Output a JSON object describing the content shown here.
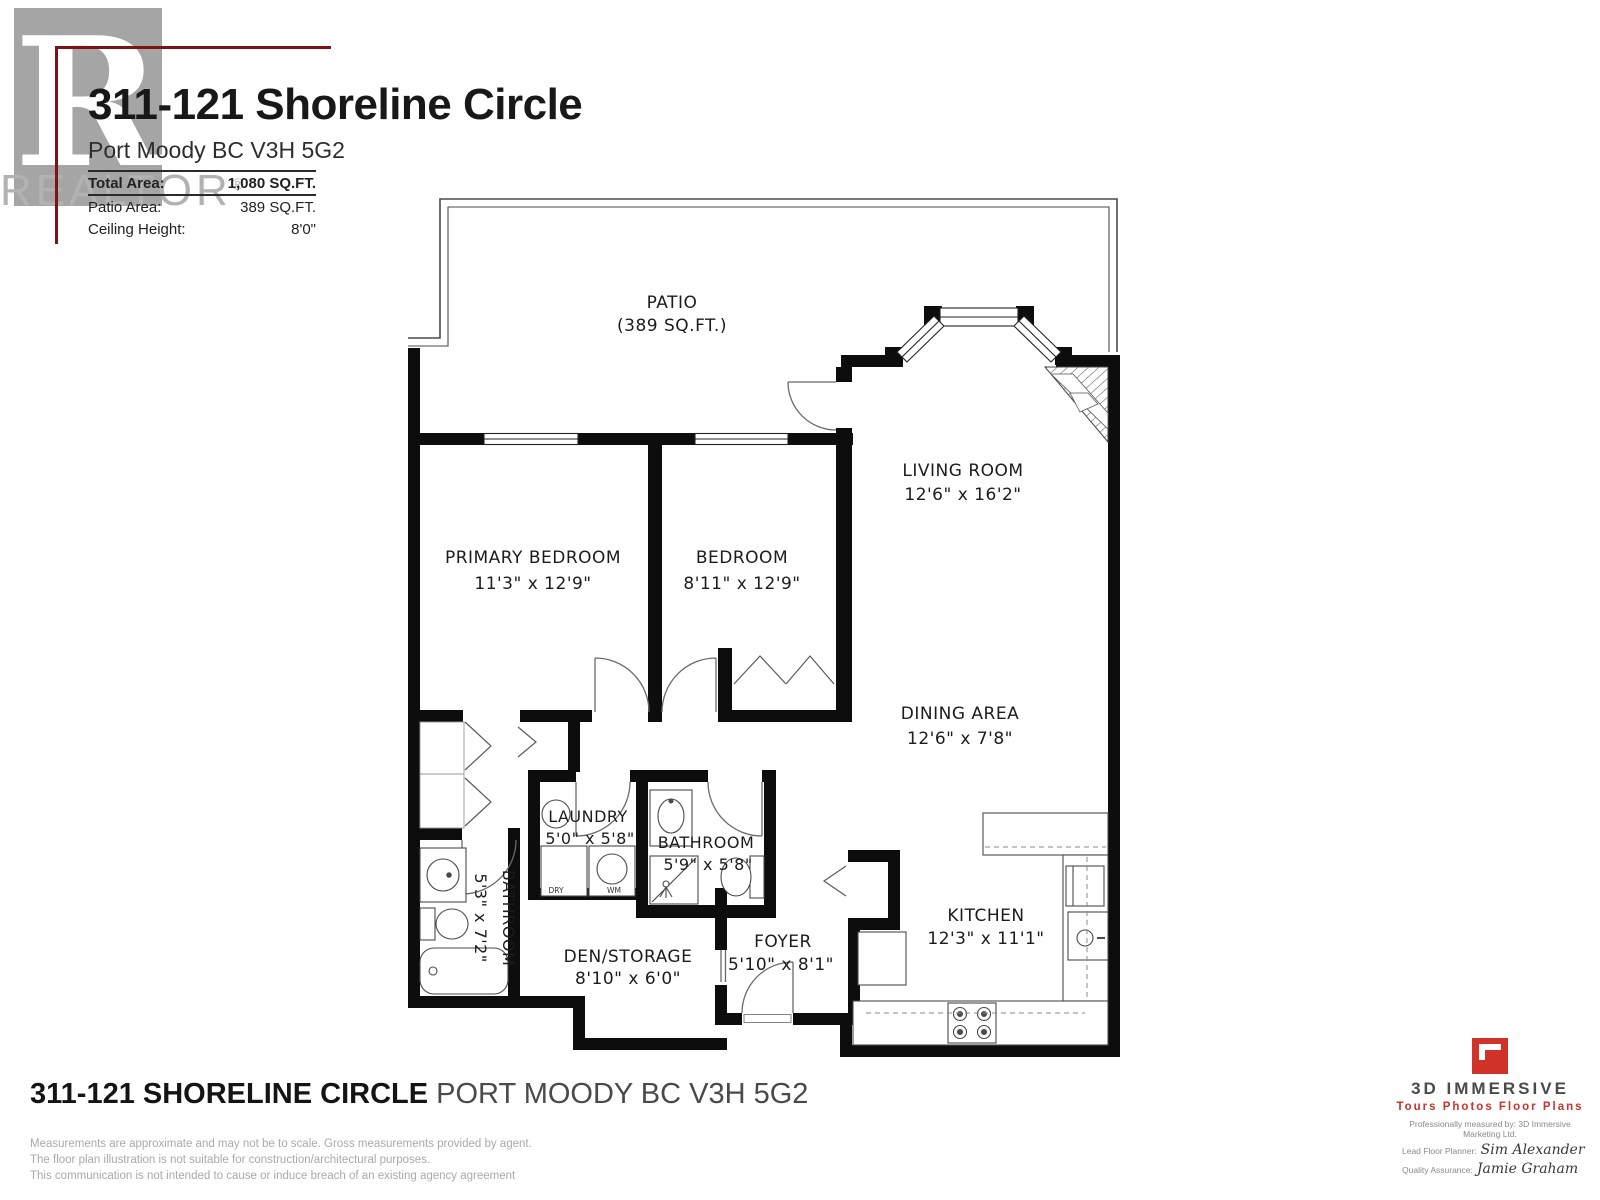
{
  "header": {
    "title": "311-121 Shoreline Circle",
    "address": "Port Moody BC V3H 5G2",
    "stats": [
      {
        "label": "Total Area:",
        "value": "1,080 SQ.FT."
      },
      {
        "label": "Patio Area:",
        "value": "389 SQ.FT."
      },
      {
        "label": "Ceiling Height:",
        "value": "8'0\""
      }
    ],
    "watermark_letter": "R",
    "watermark_word": "REALTOR",
    "watermark_reg": "®"
  },
  "plan": {
    "rooms": [
      {
        "id": "patio",
        "name": "PATIO",
        "dims": "(389 SQ.FT.)"
      },
      {
        "id": "living-room",
        "name": "LIVING ROOM",
        "dims": "12'6\" x 16'2\""
      },
      {
        "id": "primary-bedroom",
        "name": "PRIMARY BEDROOM",
        "dims": "11'3\" x 12'9\""
      },
      {
        "id": "bedroom",
        "name": "BEDROOM",
        "dims": "8'11\" x 12'9\""
      },
      {
        "id": "dining-area",
        "name": "DINING AREA",
        "dims": "12'6\" x 7'8\""
      },
      {
        "id": "laundry",
        "name": "LAUNDRY",
        "dims": "5'0\" x 5'8\""
      },
      {
        "id": "bathroom-main",
        "name": "BATHROOM",
        "dims": "5'9\" x 5'8\""
      },
      {
        "id": "bathroom-side",
        "name": "BATHROOM",
        "dims": "5'3\" x 7'2\""
      },
      {
        "id": "den-storage",
        "name": "DEN/STORAGE",
        "dims": "8'10\" x 6'0\""
      },
      {
        "id": "foyer",
        "name": "FOYER",
        "dims": "5'10\" x 8'1\""
      },
      {
        "id": "kitchen",
        "name": "KITCHEN",
        "dims": "12'3\" x 11'1\""
      }
    ],
    "appliance_labels": {
      "dryer": "DRY",
      "washer": "WM"
    }
  },
  "footer": {
    "address_bold": "311-121 SHORELINE CIRCLE",
    "address_rest": " PORT MOODY BC V3H 5G2",
    "disclaimers": [
      "Measurements are approximate and may not be to scale. Gross measurements provided by agent.",
      "The floor plan illustration is not suitable for construction/architectural purposes.",
      "This communication is not intended to cause or induce breach of an existing agency agreement"
    ]
  },
  "branding": {
    "name": "3D IMMERSIVE",
    "tagline": "Tours  Photos  Floor Plans",
    "measured_by": "Professionally measured by: 3D Immersive Marketing Ltd.",
    "planner_label": "Lead Floor Planner:",
    "planner_name": "Sim Alexander",
    "qa_label": "Quality Assurance:",
    "qa_name": "Jamie Graham"
  },
  "colors": {
    "wall_black": "#0d0d0d",
    "accent_red": "#d13328",
    "header_line_red": "#7e1315",
    "watermark_gray": "#b2b2b2"
  }
}
